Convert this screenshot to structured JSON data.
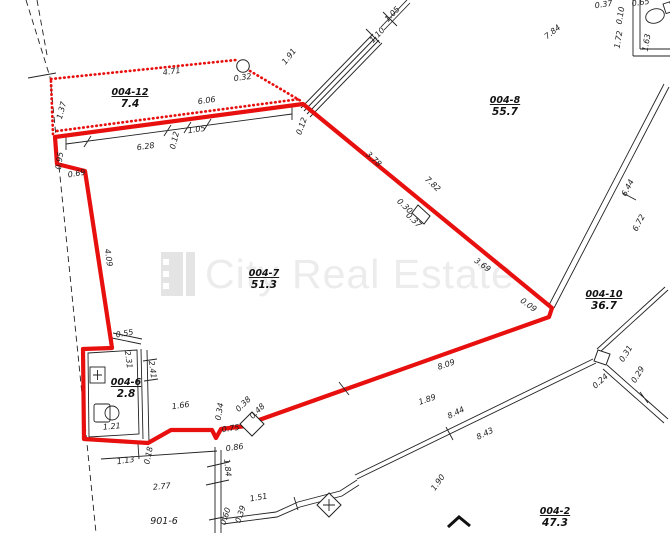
{
  "document": {
    "type": "cadastral-floor-plan"
  },
  "watermark": {
    "text": "City Real Estate"
  },
  "colors": {
    "highlight_red": "#e8100e",
    "line_black": "#1c1c1c",
    "watermark_gray": "#ececec"
  },
  "plan": {
    "rooms": [
      {
        "id": "004-12",
        "area": "7.4",
        "x": 130,
        "y": 95
      },
      {
        "id": "004-8",
        "area": "55.7",
        "x": 505,
        "y": 103
      },
      {
        "id": "004-7",
        "area": "51.3",
        "x": 264,
        "y": 276
      },
      {
        "id": "004-10",
        "area": "36.7",
        "x": 604,
        "y": 297
      },
      {
        "id": "004-6",
        "area": "2.8",
        "x": 126,
        "y": 385
      },
      {
        "id": "004-2",
        "area": "47.3",
        "x": 555,
        "y": 514
      }
    ],
    "dimensions": [
      {
        "t": "4.71",
        "x": 172,
        "y": 74,
        "r": -8
      },
      {
        "t": "0.32",
        "x": 243,
        "y": 80,
        "r": -8
      },
      {
        "t": "1.91",
        "x": 291,
        "y": 58,
        "r": -52
      },
      {
        "t": "6.06",
        "x": 207,
        "y": 103,
        "r": -8
      },
      {
        "t": "1.37",
        "x": 64,
        "y": 111,
        "r": -75
      },
      {
        "t": "6.28",
        "x": 146,
        "y": 149,
        "r": -8
      },
      {
        "t": "0.12",
        "x": 177,
        "y": 141,
        "r": -76
      },
      {
        "t": "1.05",
        "x": 197,
        "y": 132,
        "r": -8
      },
      {
        "t": "0.95",
        "x": 62,
        "y": 161,
        "r": -83
      },
      {
        "t": "0.69",
        "x": 77,
        "y": 176,
        "r": -10
      },
      {
        "t": "4.09",
        "x": 106,
        "y": 258,
        "r": 82
      },
      {
        "t": "0.12",
        "x": 304,
        "y": 127,
        "r": -70
      },
      {
        "t": "1.10",
        "x": 379,
        "y": 37,
        "r": -46
      },
      {
        "t": "1.05",
        "x": 394,
        "y": 16,
        "r": -46
      },
      {
        "t": "7.84",
        "x": 554,
        "y": 34,
        "r": -38
      },
      {
        "t": "0.37",
        "x": 604,
        "y": 7,
        "r": -8
      },
      {
        "t": "0.65",
        "x": 641,
        "y": 5,
        "r": -8
      },
      {
        "t": "0.10",
        "x": 623,
        "y": 16,
        "r": -80
      },
      {
        "t": "1.72",
        "x": 621,
        "y": 40,
        "r": -80
      },
      {
        "t": "1.63",
        "x": 649,
        "y": 43,
        "r": -80
      },
      {
        "t": "3.78",
        "x": 372,
        "y": 161,
        "r": 43
      },
      {
        "t": "7.82",
        "x": 431,
        "y": 186,
        "r": 43
      },
      {
        "t": "0.30",
        "x": 403,
        "y": 208,
        "r": 43
      },
      {
        "t": "0.37",
        "x": 412,
        "y": 222,
        "r": 43
      },
      {
        "t": "3.69",
        "x": 481,
        "y": 267,
        "r": 36
      },
      {
        "t": "0.09",
        "x": 527,
        "y": 307,
        "r": 36
      },
      {
        "t": "6.44",
        "x": 630,
        "y": 189,
        "r": -62
      },
      {
        "t": "6.72",
        "x": 641,
        "y": 224,
        "r": -62
      },
      {
        "t": "8.09",
        "x": 447,
        "y": 367,
        "r": -19
      },
      {
        "t": "1.89",
        "x": 428,
        "y": 402,
        "r": -19
      },
      {
        "t": "8.44",
        "x": 457,
        "y": 415,
        "r": -26
      },
      {
        "t": "8.43",
        "x": 486,
        "y": 436,
        "r": -26
      },
      {
        "t": "1.90",
        "x": 440,
        "y": 484,
        "r": -55
      },
      {
        "t": "0.31",
        "x": 628,
        "y": 355,
        "r": -58
      },
      {
        "t": "0.29",
        "x": 640,
        "y": 376,
        "r": -58
      },
      {
        "t": "0.24",
        "x": 602,
        "y": 383,
        "r": -42
      },
      {
        "t": "1.51",
        "x": 259,
        "y": 500,
        "r": -10
      },
      {
        "t": "0.60",
        "x": 228,
        "y": 517,
        "r": -72
      },
      {
        "t": "0.39",
        "x": 243,
        "y": 515,
        "r": -72
      },
      {
        "t": "901-6",
        "x": 164,
        "y": 524,
        "r": 0,
        "s": 1
      },
      {
        "t": "2.77",
        "x": 162,
        "y": 489,
        "r": -5
      },
      {
        "t": "1.13",
        "x": 126,
        "y": 463,
        "r": -8
      },
      {
        "t": "0.18",
        "x": 151,
        "y": 456,
        "r": -78
      },
      {
        "t": "0.86",
        "x": 235,
        "y": 450,
        "r": -8
      },
      {
        "t": "1.84",
        "x": 225,
        "y": 468,
        "r": 84
      },
      {
        "t": "0.55",
        "x": 125,
        "y": 336,
        "r": -10
      },
      {
        "t": "2.31",
        "x": 126,
        "y": 360,
        "r": 82
      },
      {
        "t": "2.41",
        "x": 150,
        "y": 370,
        "r": 82
      },
      {
        "t": "1.21",
        "x": 112,
        "y": 429,
        "r": -5
      },
      {
        "t": "1.66",
        "x": 181,
        "y": 408,
        "r": -8
      },
      {
        "t": "0.34",
        "x": 222,
        "y": 412,
        "r": -80
      },
      {
        "t": "0.38",
        "x": 245,
        "y": 406,
        "r": -45
      },
      {
        "t": "0.48",
        "x": 259,
        "y": 413,
        "r": -45
      },
      {
        "t": "0.75",
        "x": 231,
        "y": 431,
        "r": -8
      }
    ]
  }
}
